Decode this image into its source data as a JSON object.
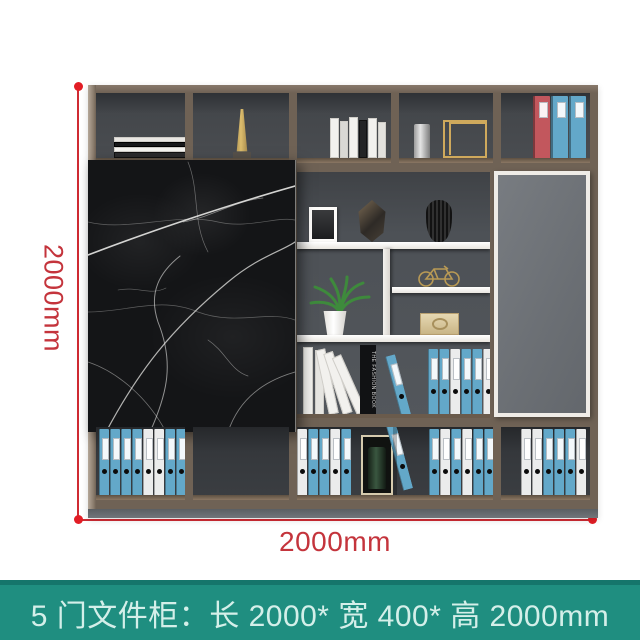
{
  "annotations": {
    "height_label": "2000mm",
    "width_label": "2000mm",
    "line_color": "#cf2b33",
    "dot_color": "#e21d25",
    "label_color": "#c4343c"
  },
  "caption": {
    "text": "5 门文件柜：长 2000* 宽 400* 高 2000mm",
    "bg_color": "#1f8e80",
    "text_color": "#d4efe9"
  },
  "cabinet": {
    "wood_color": "#6f6255",
    "interior_color": "#3a3d41",
    "shelf_color": "#f4f2ee",
    "marble_door_color": "#141517",
    "gray_door_color": "#6f7377",
    "plinth_color": "#71757a"
  },
  "items": {
    "fashion_book_spine": "THE FASHION BOOK"
  },
  "binder_colors": {
    "b": "#63a8c9",
    "w": "#ebecec",
    "r": "#c2575d"
  },
  "binder_rows": {
    "top_right": [
      "r",
      "b",
      "b"
    ],
    "bottom_left": [
      "b",
      "b",
      "b",
      "b",
      "w",
      "w",
      "b",
      "b",
      "b",
      "w"
    ],
    "bottom_mid_left": [
      "w",
      "b",
      "b",
      "w",
      "b"
    ],
    "bottom_mid_right": [
      "b",
      "w",
      "b",
      "w",
      "b",
      "b"
    ],
    "bottom_right": [
      "w",
      "w",
      "b",
      "b",
      "b",
      "w"
    ],
    "shelf_binders": [
      "b",
      "b",
      "w",
      "b",
      "b",
      "w"
    ]
  }
}
